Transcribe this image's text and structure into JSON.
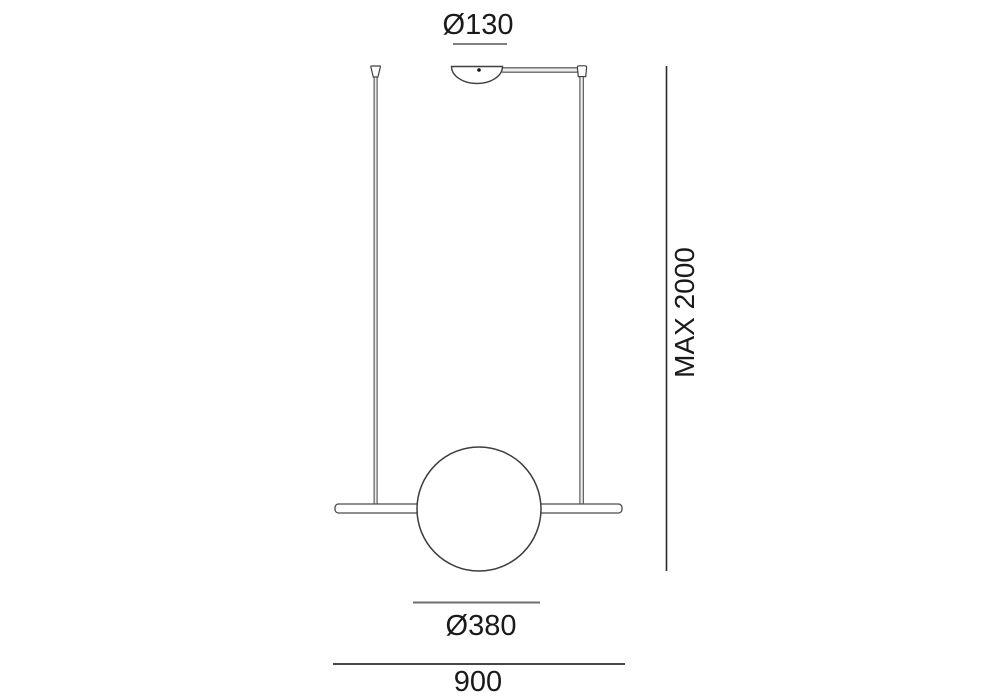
{
  "diagram": {
    "type": "pendant-lamp-dimension-drawing",
    "labels": {
      "canopy_diameter": "Ø130",
      "max_height": "MAX 2000",
      "sphere_diameter": "Ø380",
      "overall_width": "900"
    },
    "colors": {
      "background": "#ffffff",
      "text": "#1a1a1a",
      "dimension_line_dark": "#2b2b2b",
      "dimension_line_gray": "#6e6e6e",
      "fixture_outline": "#3f3f3f",
      "fixture_fill": "#ffffff",
      "wire_fill": "#ededed"
    }
  }
}
